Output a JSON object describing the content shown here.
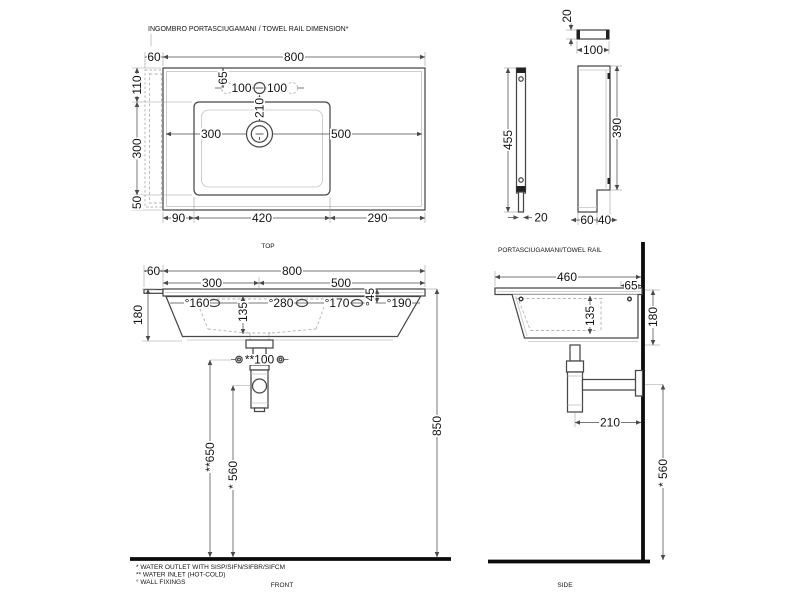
{
  "title": "INGOMBRO PORTASCIUGAMANI / TOWEL RAIL DIMENSION*",
  "view_labels": {
    "top": "TOP",
    "front": "FRONT",
    "side": "SIDE",
    "rail": "PORTASCIUGAMANI/TOWEL RAIL"
  },
  "footnotes": {
    "outlet": "*  WATER OUTLET WITH SISP/SIFN/SIFBR/SIFCM",
    "inlet": "** WATER INLET  (HOT-COLD)",
    "fixings": "° WALL FIXINGS"
  },
  "top_view": {
    "dims": {
      "rail_w": "60",
      "width": "800",
      "rear": "110",
      "bowl_d": "300",
      "front": "50",
      "faucet_off": "65",
      "faucet_l": "100",
      "faucet_r": "100",
      "drain_off": "210",
      "split_l": "300",
      "split_r": "500",
      "m_left": "90",
      "bowl_w": "420",
      "m_right": "290"
    }
  },
  "rail_view": {
    "dims": {
      "bracket_d": "20",
      "bracket_w": "100",
      "bar_h": "455",
      "bar_w": "20",
      "plate_h": "390",
      "foot_l": "60",
      "foot_r": "40"
    }
  },
  "front_view": {
    "dims": {
      "rail_w": "60",
      "width": "800",
      "split_l": "300",
      "split_r": "500",
      "fix1": "°160",
      "fix2": "°280",
      "fix3": "°170",
      "fix4": "°190",
      "fix_v": "°45",
      "mid": "135",
      "height": "180",
      "inlet": "**100",
      "outlet_h": "**650",
      "siphon_h": "* 560",
      "total_h": "850"
    }
  },
  "side_view": {
    "dims": {
      "depth": "460",
      "wall_off": "65",
      "mid": "135",
      "height": "180",
      "trap": "210",
      "siphon_h": "* 560"
    }
  }
}
